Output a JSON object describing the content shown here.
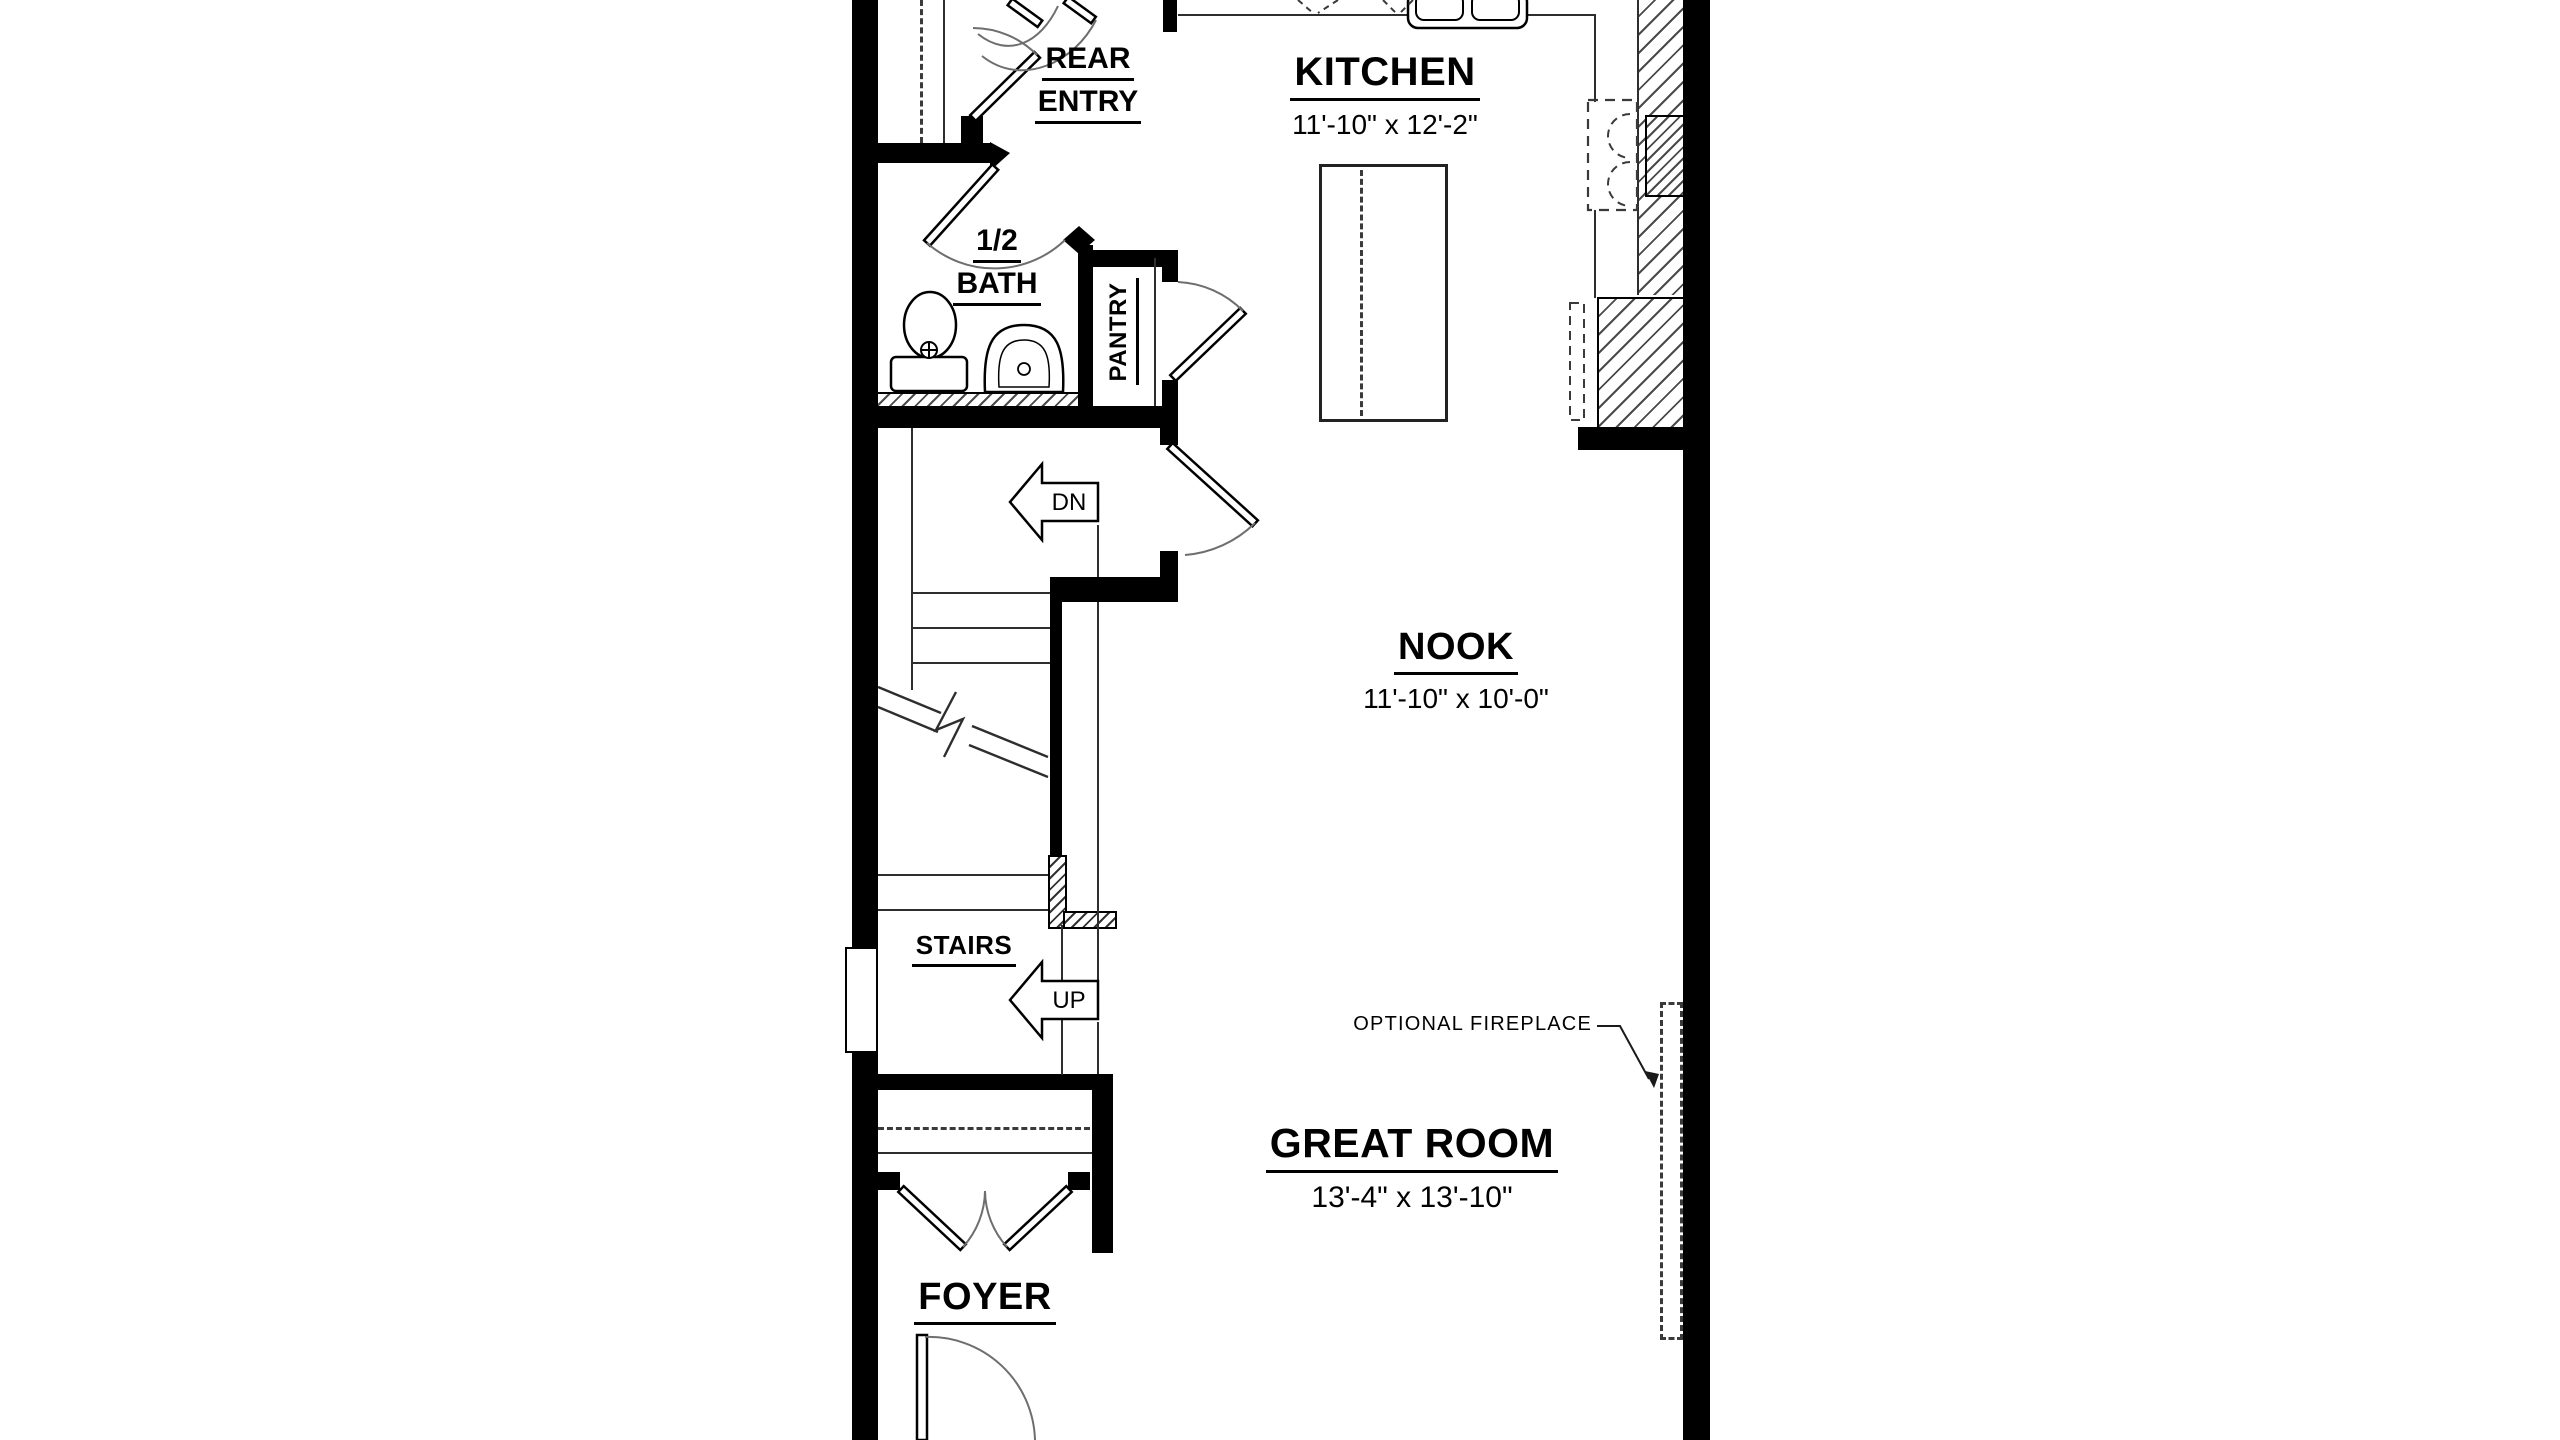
{
  "floor_plan": {
    "rooms": {
      "rear_entry": {
        "line1": "REAR",
        "line2": "ENTRY"
      },
      "kitchen": {
        "label": "KITCHEN",
        "dims": "11'-10\" x 12'-2\""
      },
      "half_bath": {
        "line1": "1/2",
        "line2": "BATH"
      },
      "pantry": {
        "label": "PANTRY"
      },
      "nook": {
        "label": "NOOK",
        "dims": "11'-10\" x 10'-0\""
      },
      "stairs": {
        "label": "STAIRS"
      },
      "great_room": {
        "label": "GREAT ROOM",
        "dims": "13'-4\" x 13'-10\""
      },
      "foyer": {
        "label": "FOYER"
      }
    },
    "annotations": {
      "down": "DN",
      "up": "UP",
      "optional_fireplace": "OPTIONAL FIREPLACE"
    },
    "colors": {
      "walls": "#000000",
      "linework": "#333333",
      "background": "#ffffff"
    }
  }
}
